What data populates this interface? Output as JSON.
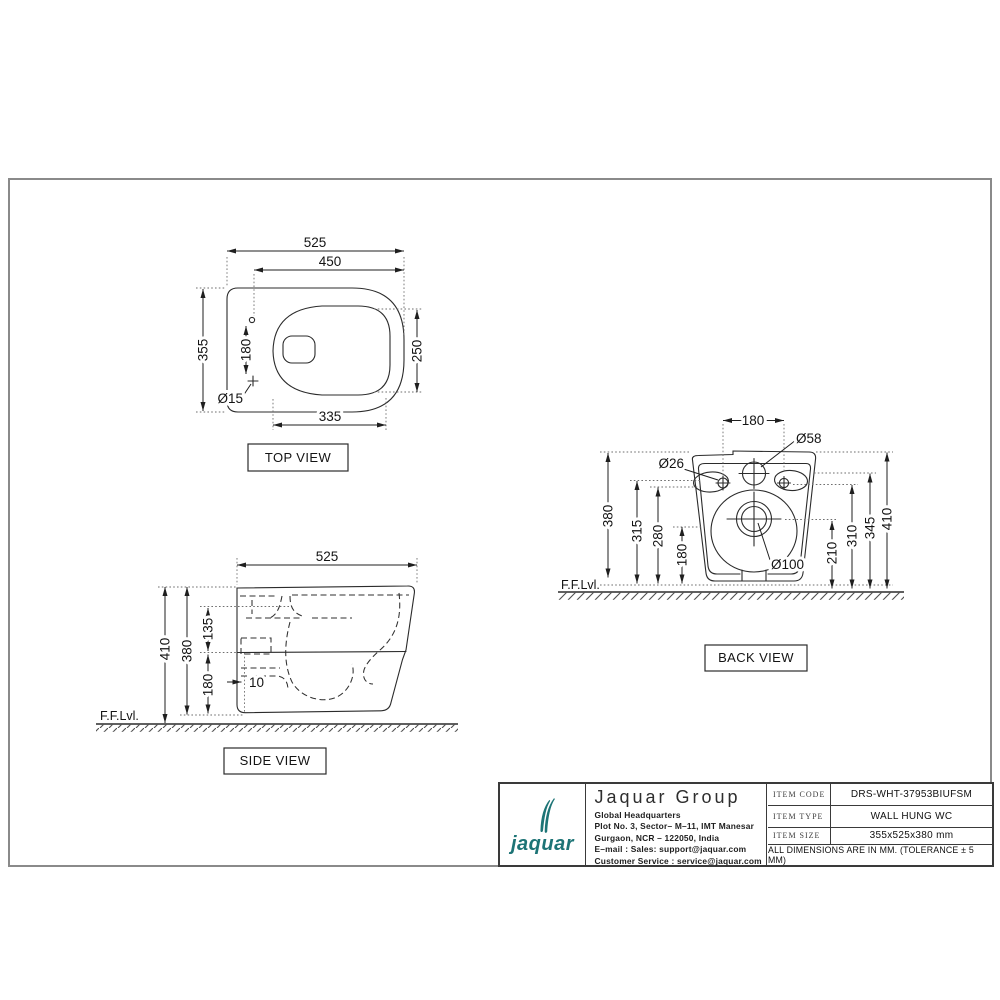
{
  "frame": {
    "border_color": "#8a8a8a"
  },
  "views": {
    "top": {
      "label": "TOP VIEW",
      "dims": {
        "overall_width": "525",
        "hinge_to_front": "450",
        "overall_depth": "355",
        "hinge_hole_spacing": "180",
        "bowl_width": "250",
        "hinge_hole_dia": "Ø15",
        "bowl_length": "335"
      }
    },
    "side": {
      "label": "SIDE VIEW",
      "floor": "F.F.Lvl.",
      "dims": {
        "overall_length": "525",
        "overall_height": "410",
        "body_height": "380",
        "top_to_rim": "135",
        "floor_clearance": "180",
        "wall_offset": "10"
      }
    },
    "back": {
      "label": "BACK VIEW",
      "floor": "F.F.Lvl.",
      "dims": {
        "bolt_spacing": "180",
        "inlet_dia": "Ø58",
        "bolt_hole_dia": "Ø26",
        "height_380": "380",
        "height_315": "315",
        "height_280": "280",
        "height_180": "180",
        "outlet_dia": "Ø100",
        "height_210": "210",
        "height_310": "310",
        "height_345": "345",
        "height_410": "410"
      }
    }
  },
  "title_block": {
    "brand_color": "#1d7476",
    "logo_text": "jaquar",
    "company_name": "Jaquar Group",
    "address": [
      "Global Headquarters",
      "Plot No. 3, Sector– M–11, IMT Manesar",
      "Gurgaon, NCR – 122050, India",
      "E–mail : Sales: support@jaquar.com",
      "Customer Service : service@jaquar.com"
    ],
    "item_code_label": "ITEM CODE",
    "item_code_value": "DRS-WHT-37953BIUFSM",
    "item_type_label": "ITEM TYPE",
    "item_type_value": "WALL HUNG WC",
    "item_size_label": "ITEM SIZE",
    "item_size_value": "355x525x380 mm",
    "note": "ALL DIMENSIONS ARE IN MM. (TOLERANCE ± 5 MM)"
  }
}
